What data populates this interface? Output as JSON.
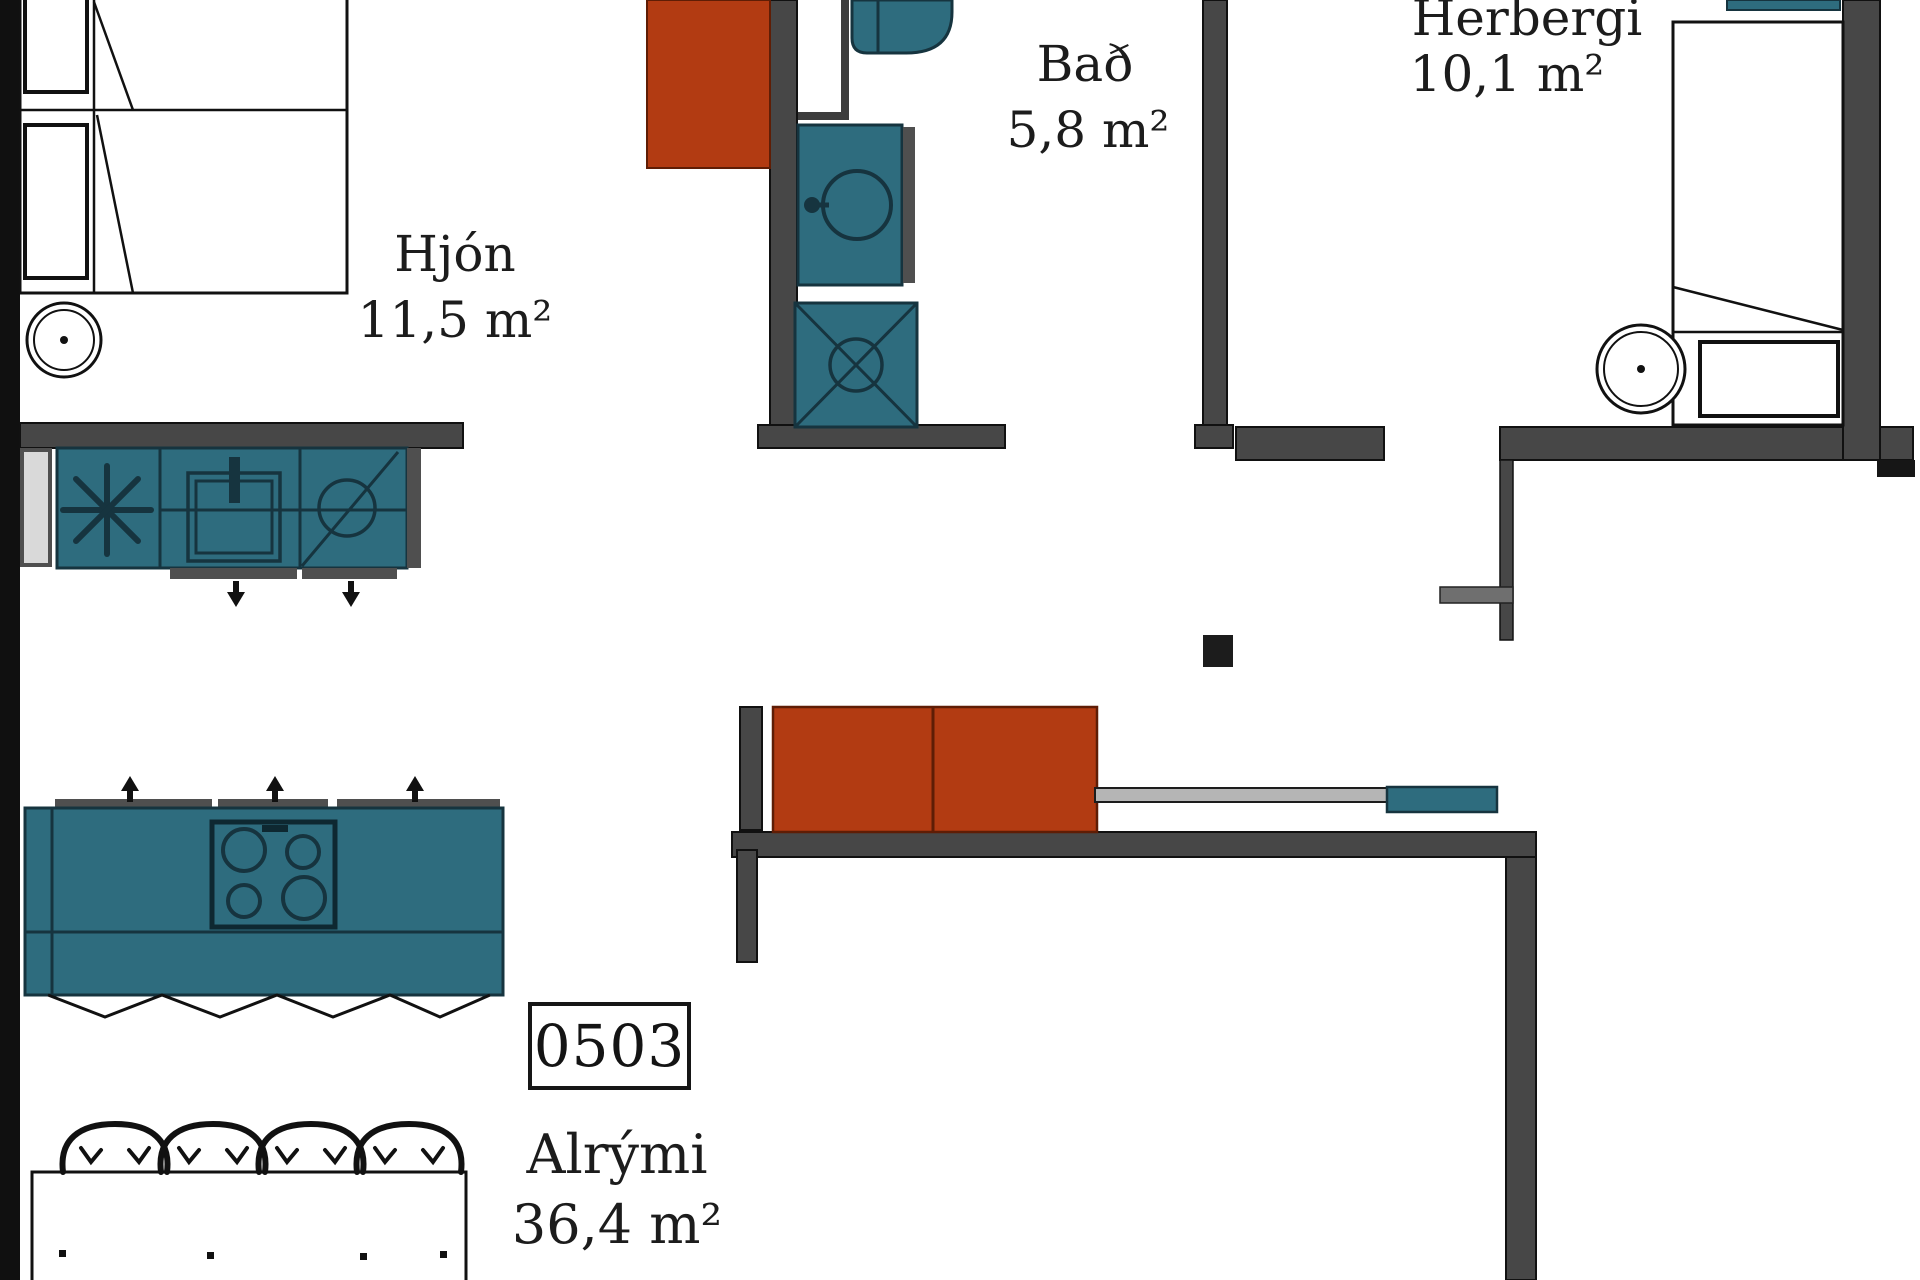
{
  "title": "Apartment floor plan",
  "unit": {
    "number": "0503"
  },
  "rooms": {
    "hjon": {
      "name": "Hjón",
      "area": "11,5 m²"
    },
    "bad": {
      "name": "Bað",
      "area": "5,8 m²"
    },
    "herbergi": {
      "name": "Herbergi",
      "area": "10,1 m²"
    },
    "alrymi": {
      "name": "Alrými",
      "area": "36,4 m²"
    }
  },
  "colors": {
    "fixture_teal": "#2e6c7e",
    "fixture_teal_line": "#16343f",
    "accent_red": "#b23b12",
    "wall_gray": "#474747",
    "wall_black": "#101010",
    "appliance_gray": "#d9d9d9",
    "console_gray": "#b5b5b5",
    "line_black": "#111111"
  }
}
